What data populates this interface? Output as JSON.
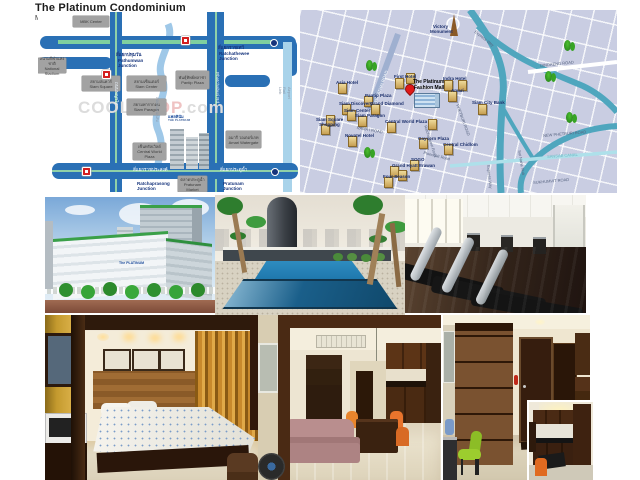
{
  "page": {
    "title": "The Platinum Condominium",
    "subtitle": "Map/Location",
    "stray_label": "Rd"
  },
  "watermark": {
    "part1": "COOL",
    "part2": "PROP",
    "part3": ".com"
  },
  "schematic_map": {
    "logo_th": "แพลทินัม",
    "logo_en": "THE PLATINUM",
    "boxes": [
      {
        "en": "MBK Center",
        "x": 35,
        "y": 4,
        "w": 36,
        "h": 11
      },
      {
        "th": "สนามกีฬาแห่งชาติ",
        "en": "National Stadium",
        "x": 0,
        "y": 46,
        "w": 28,
        "h": 15
      },
      {
        "th": "สยามสแควร์",
        "en": "Siam Square",
        "x": 44,
        "y": 64,
        "w": 38,
        "h": 15
      },
      {
        "th": "สยามเซ็นเตอร์",
        "en": "Siam Center",
        "x": 89,
        "y": 64,
        "w": 39,
        "h": 15
      },
      {
        "th": "สยามพารากอน",
        "en": "Siam Paragon",
        "x": 89,
        "y": 87,
        "w": 39,
        "h": 16
      },
      {
        "th": "พันธุ์ทิพย์พลาซ่า",
        "en": "Pantip Plaza",
        "x": 138,
        "y": 59,
        "w": 33,
        "h": 18
      },
      {
        "th": "อมารี วอเตอร์เกท",
        "en": "Amari Watergate",
        "x": 188,
        "y": 119,
        "w": 35,
        "h": 17
      },
      {
        "th": "เซ็นทรัลเวิลด์",
        "en": "Central World Plaza",
        "x": 95,
        "y": 131,
        "w": 33,
        "h": 17
      },
      {
        "th": "ตลาดประตูน้ำ",
        "en": "Pratunam Market",
        "x": 140,
        "y": 164,
        "w": 29,
        "h": 16
      }
    ],
    "texts": [
      {
        "t": "สี่แยกปทุมวัน",
        "x": 78,
        "y": 40,
        "cls": "jt"
      },
      {
        "t": "Pathumwan\nJunction",
        "x": 80,
        "y": 46,
        "cls": "je"
      },
      {
        "t": "สี่แยกราชเทวี",
        "x": 180,
        "y": 33,
        "cls": "jt"
      },
      {
        "t": "Ratchathewee\nJunction",
        "x": 181,
        "y": 39,
        "cls": "je"
      },
      {
        "t": "สี่แยกราชประสงค์",
        "x": 95,
        "y": 155,
        "cls": "wt"
      },
      {
        "t": "Ratchaprasong\nJunction",
        "x": 99,
        "y": 169,
        "cls": "je"
      },
      {
        "t": "สี่แยกประตูน้ำ",
        "x": 182,
        "y": 155,
        "cls": "wt"
      },
      {
        "t": "Pratunam\nJunction",
        "x": 185,
        "y": 169,
        "cls": "je"
      },
      {
        "t": "ถนนพญาไท",
        "x": 81,
        "y": 70,
        "cls": "wv",
        "rot": 90
      },
      {
        "t": "Phetchaburi Rd.",
        "x": 182,
        "y": 60,
        "cls": "wv",
        "rot": 90
      },
      {
        "t": "Airport Rail Link",
        "x": 253,
        "y": 75,
        "cls": "gv",
        "rot": 90
      },
      {
        "t": "คลองแสนแสบ",
        "x": 121,
        "y": 85,
        "cls": "gv",
        "rot": 90
      }
    ],
    "icons": [
      {
        "cls": "ic-red",
        "x": 143,
        "y": 24
      },
      {
        "cls": "ic-red",
        "x": 44,
        "y": 155
      },
      {
        "cls": "ic-red",
        "x": 64,
        "y": 58
      },
      {
        "cls": "ic-dot",
        "x": 232,
        "y": 27
      },
      {
        "cls": "ic-dot",
        "x": 233,
        "y": 156
      }
    ]
  },
  "area_map": {
    "labels": [
      {
        "t": "Victory",
        "x": 133,
        "y": 14,
        "cls": "nb"
      },
      {
        "t": "Monument",
        "x": 130,
        "y": 19,
        "cls": "nb"
      },
      {
        "t": "Express Way",
        "x": 176,
        "y": 20,
        "cls": "rd",
        "rot": 38
      },
      {
        "t": "DINDAENG ROAD",
        "x": 240,
        "y": 54,
        "cls": "rd",
        "rot": -6
      },
      {
        "t": "PHAYATHAI ROAD",
        "x": 73,
        "y": 94,
        "cls": "rb",
        "rot": -70
      },
      {
        "t": "First Hotel",
        "x": 94,
        "y": 64,
        "cls": "nb"
      },
      {
        "t": "Indra Hotel",
        "x": 143,
        "y": 66,
        "cls": "nb"
      },
      {
        "t": "The Platinum",
        "x": 113,
        "y": 70,
        "cls": "mall"
      },
      {
        "t": "Fashion Mall",
        "x": 114,
        "y": 76,
        "cls": "mall"
      },
      {
        "t": "Amari",
        "x": 151,
        "y": 78,
        "cls": "nb"
      },
      {
        "t": "Asia Hotel",
        "x": 36,
        "y": 70,
        "cls": "nb"
      },
      {
        "t": "Pantip Plaza",
        "x": 65,
        "y": 83,
        "cls": "nb"
      },
      {
        "t": "Grand Diamond",
        "x": 70,
        "y": 91,
        "cls": "nb"
      },
      {
        "t": "Siam Discovery",
        "x": 39,
        "y": 91,
        "cls": "nb"
      },
      {
        "t": "Siam Center",
        "x": 44,
        "y": 98,
        "cls": "nb"
      },
      {
        "t": "Siam Paragon",
        "x": 55,
        "y": 103,
        "cls": "nb"
      },
      {
        "t": "Siam Square",
        "x": 16,
        "y": 107,
        "cls": "nb"
      },
      {
        "t": "Shopping",
        "x": 19,
        "y": 112,
        "cls": "nb"
      },
      {
        "t": "RAMA I ROAD",
        "x": 57,
        "y": 116,
        "cls": "rd",
        "rot": 10
      },
      {
        "t": "Central World Plaza",
        "x": 85,
        "y": 109,
        "cls": "nb"
      },
      {
        "t": "Novotel Hotel",
        "x": 45,
        "y": 123,
        "cls": "nb"
      },
      {
        "t": "Gaysorn Plaza",
        "x": 118,
        "y": 126,
        "cls": "nb"
      },
      {
        "t": "Central Chidlom",
        "x": 143,
        "y": 132,
        "cls": "nb"
      },
      {
        "t": "SOGO",
        "x": 111,
        "y": 147,
        "cls": "nb"
      },
      {
        "t": "Grand Hyatt Erawan",
        "x": 92,
        "y": 153,
        "cls": "nb"
      },
      {
        "t": "Four Season",
        "x": 83,
        "y": 164,
        "cls": "nb"
      },
      {
        "t": "Ploenchit Road",
        "x": 124,
        "y": 141,
        "cls": "rd",
        "rot": 14
      },
      {
        "t": "Ratchadamri Road",
        "x": 127,
        "y": 115,
        "cls": "rd",
        "rot": 72
      },
      {
        "t": "PHETBURI ROAD",
        "x": 159,
        "y": 94,
        "cls": "rd",
        "rot": 70
      },
      {
        "t": "NEW PHETBURI ROAD",
        "x": 243,
        "y": 124,
        "cls": "rd",
        "rot": -5
      },
      {
        "t": "SANSAB CANAL",
        "x": 247,
        "y": 145,
        "cls": "cn",
        "rot": -4
      },
      {
        "t": "Soi Nana Nua",
        "x": 221,
        "y": 140,
        "cls": "rd",
        "rot": 80
      },
      {
        "t": "SUKHUMVIT ROAD",
        "x": 233,
        "y": 171,
        "cls": "rd",
        "rot": -5
      },
      {
        "t": "Express Way",
        "x": 190,
        "y": 155,
        "cls": "rd",
        "rot": 84
      },
      {
        "t": "Siam City Bank",
        "x": 172,
        "y": 90,
        "cls": "nb"
      }
    ],
    "icons": [
      {
        "cls": "ic-obelisk",
        "x": 150,
        "y": 4
      },
      {
        "cls": "ic-pin",
        "x": 105,
        "y": 74
      },
      {
        "cls": "ic-mall",
        "x": 114,
        "y": 83
      },
      {
        "cls": "ic-tree",
        "x": 66,
        "y": 50
      },
      {
        "cls": "ic-tree",
        "x": 264,
        "y": 30
      },
      {
        "cls": "ic-tree",
        "x": 245,
        "y": 61
      },
      {
        "cls": "ic-tree",
        "x": 266,
        "y": 102
      },
      {
        "cls": "ic-tree",
        "x": 64,
        "y": 137
      },
      {
        "cls": "ic-bldg",
        "x": 95,
        "y": 68
      },
      {
        "cls": "ic-bldg",
        "x": 144,
        "y": 70
      },
      {
        "cls": "ic-bldg",
        "x": 38,
        "y": 73
      },
      {
        "cls": "ic-bldg",
        "x": 64,
        "y": 86
      },
      {
        "cls": "ic-bldg",
        "x": 71,
        "y": 94
      },
      {
        "cls": "ic-bldg",
        "x": 148,
        "y": 81
      },
      {
        "cls": "ic-bldg",
        "x": 42,
        "y": 94
      },
      {
        "cls": "ic-bldg",
        "x": 47,
        "y": 100
      },
      {
        "cls": "ic-bldg",
        "x": 58,
        "y": 106
      },
      {
        "cls": "ic-bldg",
        "x": 21,
        "y": 114
      },
      {
        "cls": "ic-bldg",
        "x": 87,
        "y": 112
      },
      {
        "cls": "ic-bldg",
        "x": 48,
        "y": 126
      },
      {
        "cls": "ic-bldg",
        "x": 90,
        "y": 156
      },
      {
        "cls": "ic-bldg",
        "x": 98,
        "y": 160
      },
      {
        "cls": "ic-bldg",
        "x": 110,
        "y": 150
      },
      {
        "cls": "ic-bldg",
        "x": 119,
        "y": 128
      },
      {
        "cls": "ic-bldg",
        "x": 144,
        "y": 134
      },
      {
        "cls": "ic-bldg",
        "x": 128,
        "y": 109
      },
      {
        "cls": "ic-bldg",
        "x": 84,
        "y": 167
      },
      {
        "cls": "ic-bldg",
        "x": 178,
        "y": 94
      },
      {
        "cls": "ic-bldg",
        "x": 158,
        "y": 70
      },
      {
        "cls": "ic-bldg",
        "x": 106,
        "y": 63
      },
      {
        "cls": "ic-bldg",
        "x": 26,
        "y": 105
      }
    ]
  },
  "photos": {
    "building_logo": "The PLATINUM"
  }
}
